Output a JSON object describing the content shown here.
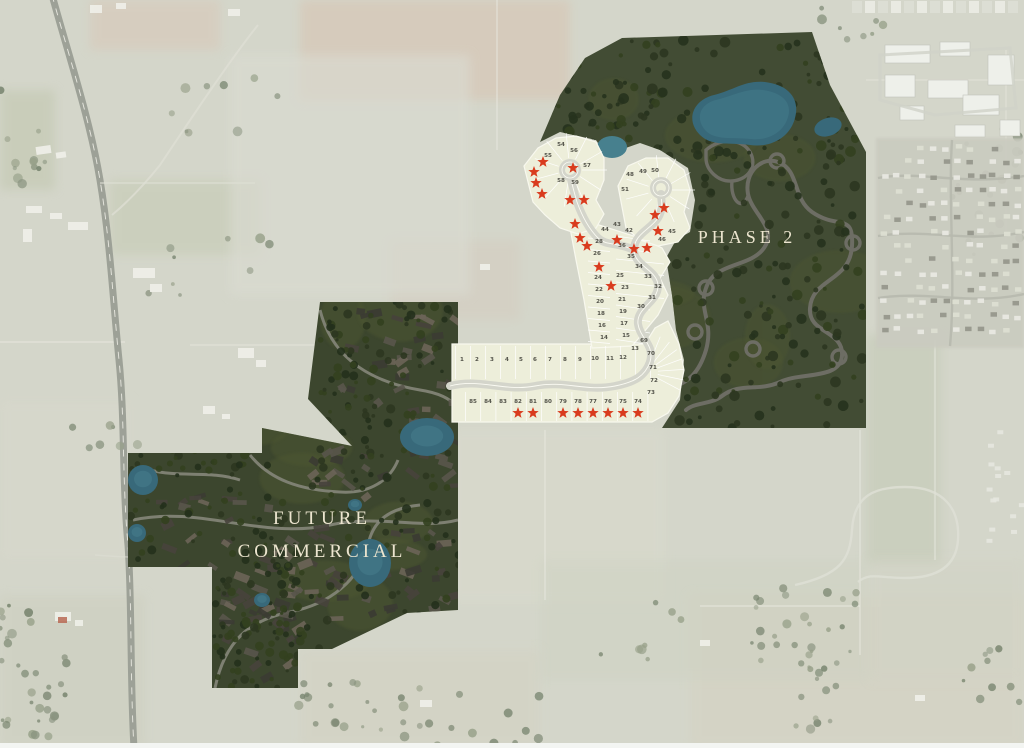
{
  "map": {
    "kind": "residential development master plan over aerial photo",
    "areas": {
      "future_commercial": {
        "label_line1": "FUTURE",
        "label_line2": "COMMERCIAL"
      },
      "phase2": {
        "label": "PHASE 2"
      }
    },
    "colors": {
      "bg": "#d4d6ca",
      "plan_green": "#424c34",
      "plan_green_dark": "#3c462e",
      "tree_green": "#2c3620",
      "lawn_green": "#4d5733",
      "lot_cream": "#edeeda",
      "lot_line": "#f8f8ee",
      "pond_teal": "#38697a",
      "pond_teal_light": "#47808e",
      "star_red": "#d93b1e",
      "label_cream": "#ece5cf",
      "plan_road": "#6d6d64",
      "lot_road": "#d4d5cb",
      "number_gray": "#53534a"
    },
    "lot_labels": [
      {
        "n": 1,
        "x": 462,
        "y": 361
      },
      {
        "n": 2,
        "x": 477,
        "y": 361
      },
      {
        "n": 3,
        "x": 492,
        "y": 361
      },
      {
        "n": 4,
        "x": 507,
        "y": 361
      },
      {
        "n": 5,
        "x": 521,
        "y": 361
      },
      {
        "n": 6,
        "x": 535,
        "y": 361
      },
      {
        "n": 7,
        "x": 550,
        "y": 361
      },
      {
        "n": 8,
        "x": 565,
        "y": 361
      },
      {
        "n": 9,
        "x": 580,
        "y": 361
      },
      {
        "n": 10,
        "x": 595,
        "y": 360
      },
      {
        "n": 11,
        "x": 610,
        "y": 360
      },
      {
        "n": 12,
        "x": 623,
        "y": 359
      },
      {
        "n": 13,
        "x": 635,
        "y": 350
      },
      {
        "n": 69,
        "x": 644,
        "y": 342
      },
      {
        "n": 70,
        "x": 651,
        "y": 355
      },
      {
        "n": 71,
        "x": 653,
        "y": 369
      },
      {
        "n": 72,
        "x": 654,
        "y": 382
      },
      {
        "n": 73,
        "x": 651,
        "y": 394
      },
      {
        "n": 85,
        "x": 473,
        "y": 403
      },
      {
        "n": 84,
        "x": 488,
        "y": 403
      },
      {
        "n": 83,
        "x": 503,
        "y": 403
      },
      {
        "n": 82,
        "x": 518,
        "y": 403
      },
      {
        "n": 81,
        "x": 533,
        "y": 403
      },
      {
        "n": 80,
        "x": 548,
        "y": 403
      },
      {
        "n": 79,
        "x": 563,
        "y": 403
      },
      {
        "n": 78,
        "x": 578,
        "y": 403
      },
      {
        "n": 77,
        "x": 593,
        "y": 403
      },
      {
        "n": 76,
        "x": 608,
        "y": 403
      },
      {
        "n": 75,
        "x": 623,
        "y": 403
      },
      {
        "n": 74,
        "x": 638,
        "y": 403
      },
      {
        "n": 14,
        "x": 604,
        "y": 339
      },
      {
        "n": 16,
        "x": 602,
        "y": 327
      },
      {
        "n": 18,
        "x": 601,
        "y": 315
      },
      {
        "n": 20,
        "x": 600,
        "y": 303
      },
      {
        "n": 22,
        "x": 599,
        "y": 291
      },
      {
        "n": 24,
        "x": 598,
        "y": 279
      },
      {
        "n": 26,
        "x": 597,
        "y": 255
      },
      {
        "n": 28,
        "x": 599,
        "y": 243
      },
      {
        "n": 15,
        "x": 626,
        "y": 337
      },
      {
        "n": 17,
        "x": 624,
        "y": 325
      },
      {
        "n": 19,
        "x": 623,
        "y": 313
      },
      {
        "n": 21,
        "x": 622,
        "y": 301
      },
      {
        "n": 23,
        "x": 625,
        "y": 289
      },
      {
        "n": 25,
        "x": 620,
        "y": 277
      },
      {
        "n": 30,
        "x": 641,
        "y": 308
      },
      {
        "n": 31,
        "x": 652,
        "y": 299
      },
      {
        "n": 32,
        "x": 658,
        "y": 288
      },
      {
        "n": 33,
        "x": 648,
        "y": 278
      },
      {
        "n": 34,
        "x": 639,
        "y": 268
      },
      {
        "n": 35,
        "x": 631,
        "y": 258
      },
      {
        "n": 36,
        "x": 622,
        "y": 247
      },
      {
        "n": 44,
        "x": 605,
        "y": 231
      },
      {
        "n": 43,
        "x": 617,
        "y": 226
      },
      {
        "n": 42,
        "x": 629,
        "y": 232
      },
      {
        "n": 54,
        "x": 561,
        "y": 146
      },
      {
        "n": 55,
        "x": 548,
        "y": 157
      },
      {
        "n": 56,
        "x": 574,
        "y": 152
      },
      {
        "n": 57,
        "x": 587,
        "y": 167
      },
      {
        "n": 58,
        "x": 561,
        "y": 182
      },
      {
        "n": 59,
        "x": 575,
        "y": 184
      },
      {
        "n": 45,
        "x": 672,
        "y": 233
      },
      {
        "n": 46,
        "x": 662,
        "y": 241
      },
      {
        "n": 48,
        "x": 630,
        "y": 176
      },
      {
        "n": 49,
        "x": 643,
        "y": 173
      },
      {
        "n": 50,
        "x": 655,
        "y": 172
      },
      {
        "n": 51,
        "x": 625,
        "y": 191
      }
    ],
    "star_positions": [
      [
        518,
        413
      ],
      [
        533,
        413
      ],
      [
        563,
        413
      ],
      [
        578,
        413
      ],
      [
        593,
        413
      ],
      [
        608,
        413
      ],
      [
        623,
        413
      ],
      [
        638,
        413
      ],
      [
        543,
        162
      ],
      [
        534,
        172
      ],
      [
        536,
        183
      ],
      [
        542,
        194
      ],
      [
        573,
        168
      ],
      [
        570,
        200
      ],
      [
        584,
        200
      ],
      [
        575,
        224
      ],
      [
        580,
        238
      ],
      [
        587,
        246
      ],
      [
        599,
        267
      ],
      [
        611,
        286
      ],
      [
        617,
        240
      ],
      [
        634,
        249
      ],
      [
        647,
        248
      ],
      [
        664,
        208
      ],
      [
        655,
        215
      ],
      [
        658,
        231
      ]
    ]
  }
}
